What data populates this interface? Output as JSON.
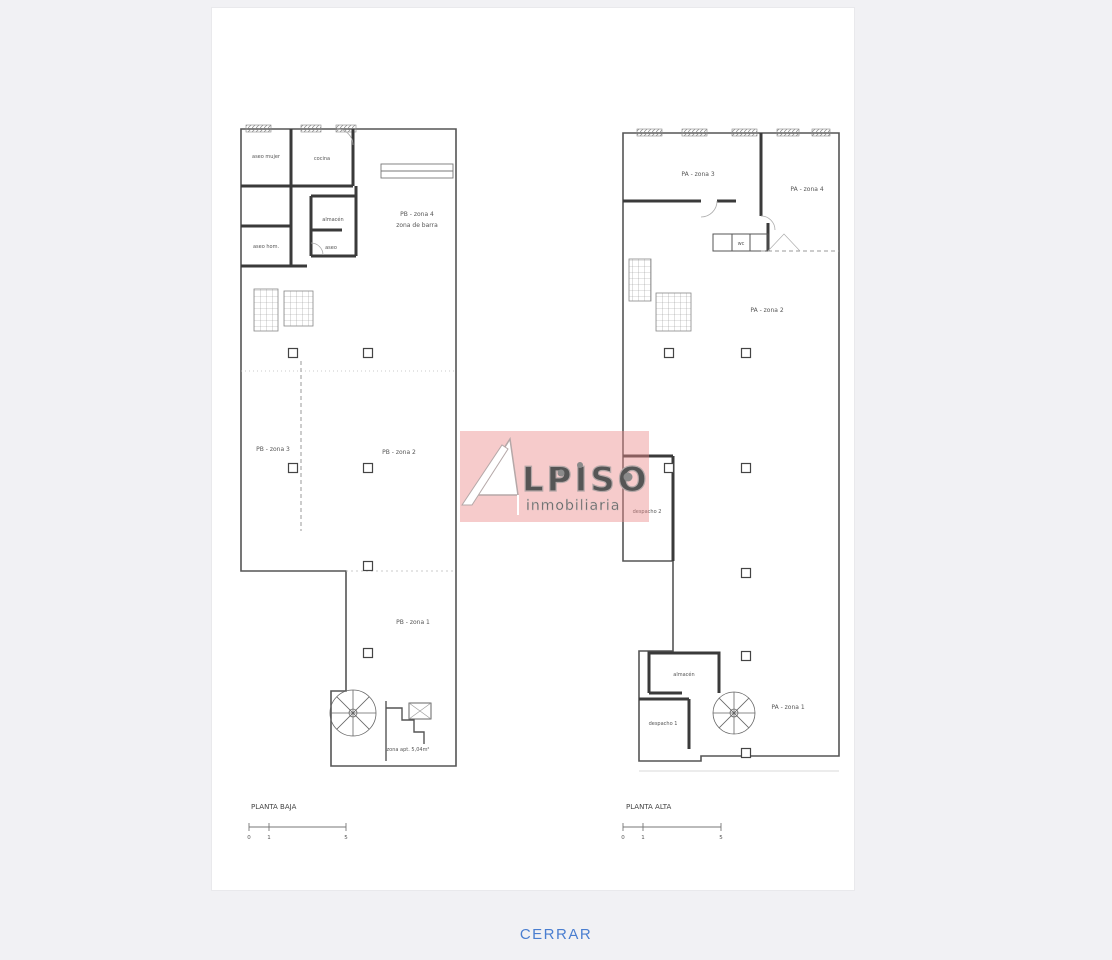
{
  "page": {
    "background": "#f1f1f4"
  },
  "close_link": {
    "label": "CERRAR",
    "color": "#4a7ed0"
  },
  "watermark": {
    "brand": "ALPISO",
    "brand_display": "LPISO",
    "tagline": "inmobiliaria",
    "panel_color": "rgba(236,140,140,0.45)"
  },
  "plans": {
    "left": {
      "title": "PLANTA BAJA",
      "scale_ticks": [
        "0",
        "1",
        "5"
      ],
      "rooms": {
        "aseo_mujer": "aseo mujer",
        "cocina": "cocina",
        "almacen": "almacén",
        "aseo": "aseo",
        "aseo_hom": "aseo hom.",
        "zona4_line1": "PB - zona 4",
        "zona4_line2": "zona de barra",
        "zona3": "PB - zona 3",
        "zona2": "PB - zona 2",
        "zona1": "PB - zona 1",
        "nota": "zona apt. 5,04m²"
      }
    },
    "right": {
      "title": "PLANTA ALTA",
      "scale_ticks": [
        "0",
        "1",
        "5"
      ],
      "rooms": {
        "zona3": "PA - zona 3",
        "zona4": "PA - zona 4",
        "zona2": "PA - zona 2",
        "despacho2": "despacho 2",
        "wc": "wc",
        "almacen": "almacén",
        "despacho1": "despacho 1",
        "zona1": "PA - zona 1"
      }
    }
  }
}
